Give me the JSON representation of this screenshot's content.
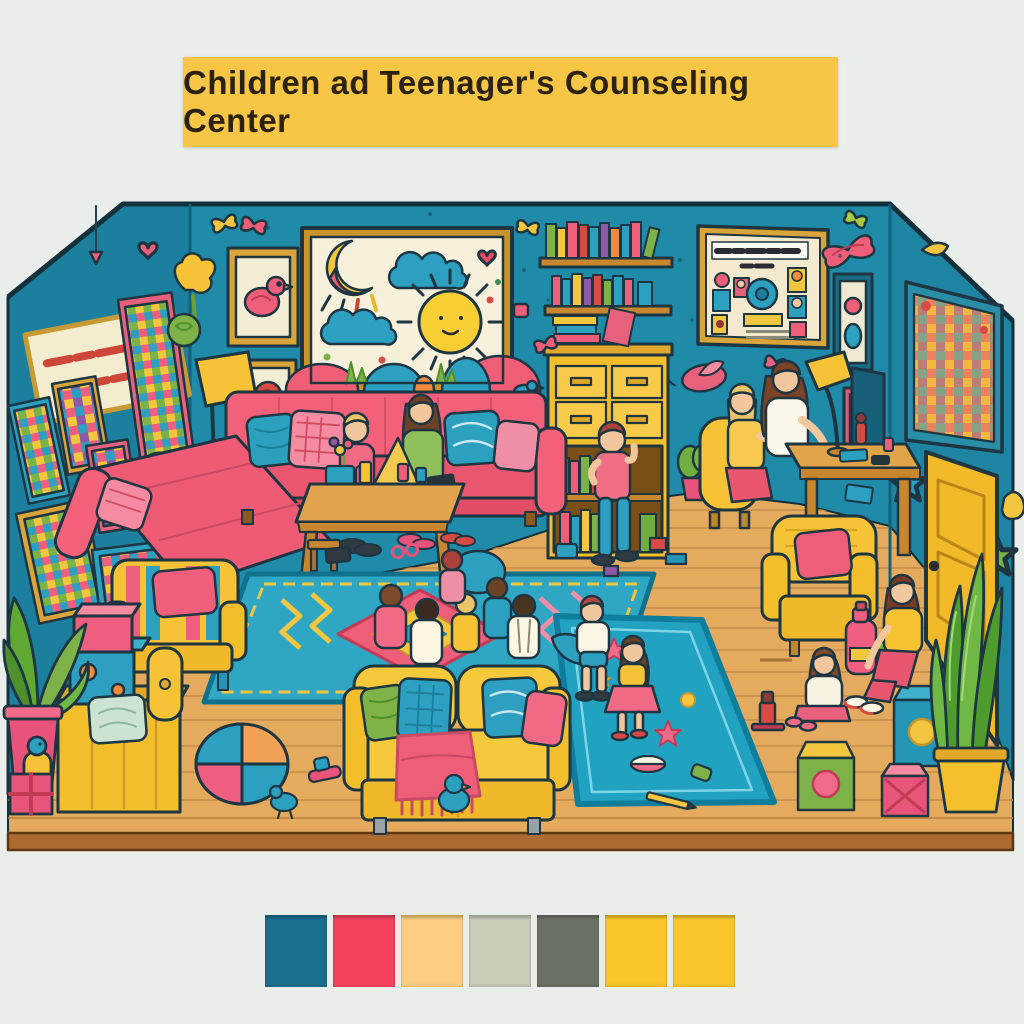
{
  "banner": {
    "title": "Children ad Teenager's Counseling Center",
    "bg_color": "#F7C645",
    "text_color": "#2B2310"
  },
  "illustration": {
    "description": "Colorful cartoon diorama of a children and teenagers counseling center room",
    "background_color": "#E9EEEB",
    "wall_color": "#1E89A8",
    "floor_color": "#E4AA5E",
    "floor_edge_color": "#AC6C31",
    "sofa_pink": "#F2607A",
    "furniture_yellow": "#F5C335",
    "accent_teal": "#2BA0BF",
    "accent_green": "#7CB247",
    "wall_sign_text": "(illegible red lettering)",
    "bulletin_title_text": "(illegible dark lettering)",
    "elements": [
      "teal diorama walls with colorful posters and decals",
      "framed child's drawing of sun, clouds and hills",
      "wall bookshelves with colorful books",
      "yellow dresser bookcase",
      "bulletin board with stickers",
      "counselor and teen at wooden desk with lamp",
      "pink sectional sofa with pillows and two figures",
      "wooden coffee table with cups and toys",
      "geometric area rug with children sitting in circle",
      "yellow loveseat with green, teal and pink pillows and pink throw",
      "teal play rug with stars and two children playing",
      "girl sitting on floor with toy robot",
      "woman seated on teal cube stool",
      "toy blocks, beachball pouf, block chair, striped armchair",
      "floor lamp, potted plants, yellow door"
    ]
  },
  "palette": {
    "swatches": [
      {
        "name": "teal-blue",
        "color": "#1A6F8D"
      },
      {
        "name": "pink-red",
        "color": "#F4425E"
      },
      {
        "name": "light-amber",
        "color": "#FACD80"
      },
      {
        "name": "sage-gray",
        "color": "#C9CBB8"
      },
      {
        "name": "dark-olive",
        "color": "#6A7265"
      },
      {
        "name": "yellow",
        "color": "#FBC628"
      },
      {
        "name": "yellow-2",
        "color": "#FBC62B"
      }
    ]
  }
}
